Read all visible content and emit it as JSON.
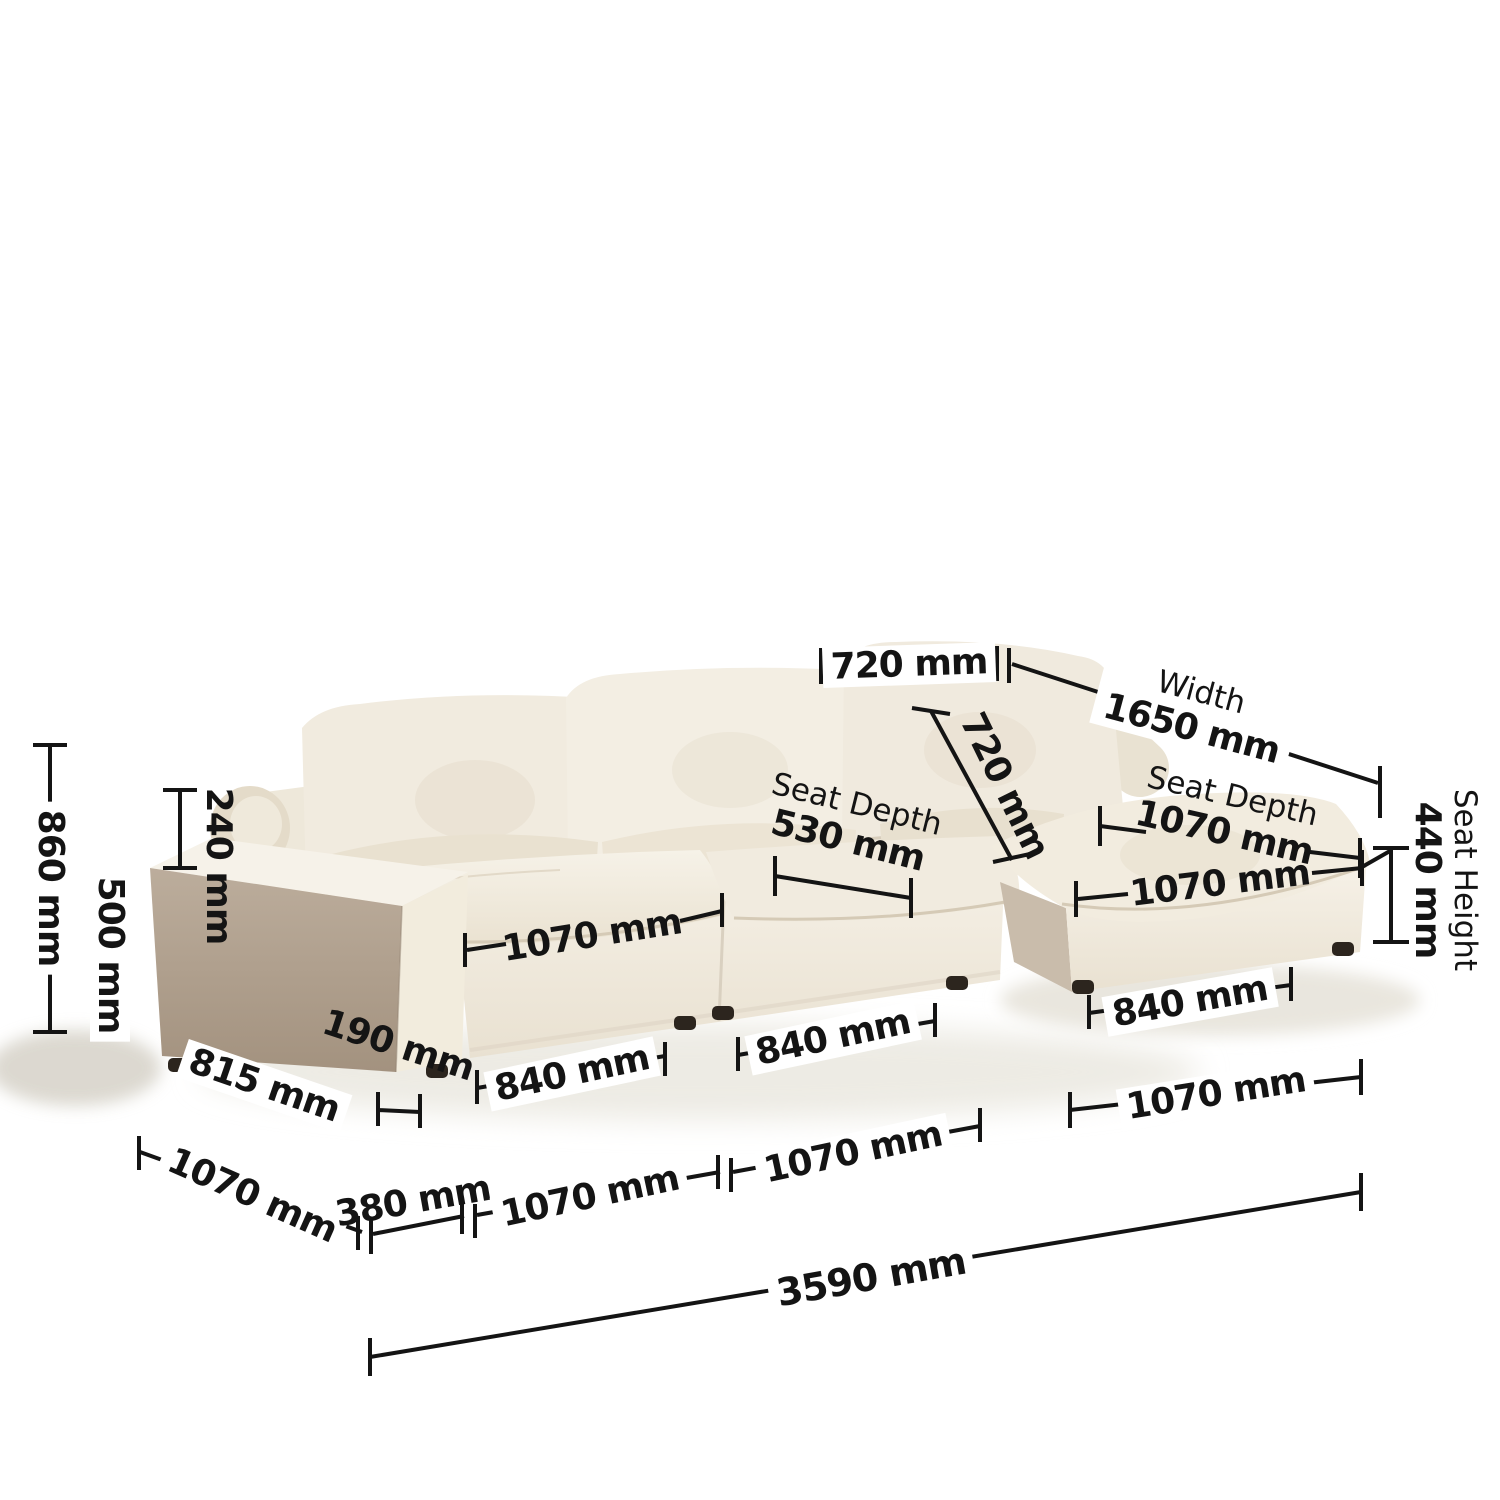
{
  "meta": {
    "description": "Product dimension diagram of a cream modular sectional cloud sofa with chaise",
    "unit": "mm"
  },
  "palette": {
    "annotation_color": "#141414",
    "background": "#ffffff",
    "sofa_cream": "#f2ecdf",
    "sofa_shadow_taupe": "#b0a08f"
  },
  "dims": {
    "back_width_top": "720 mm",
    "width_label": "Width",
    "width_value": "1650 mm",
    "back_pillow_diagonal": "720 mm",
    "seat_depth_label": "Seat Depth",
    "seat_depth_value": "530 mm",
    "chaise_seat_depth_label": "Seat Depth",
    "chaise_seat_depth_value": "1070 mm",
    "chaise_front_width": "1070 mm",
    "seat_height_label": "Seat Height",
    "seat_height_value": "440 mm",
    "overall_height": "860 mm",
    "backrest_above_arm": "240 mm",
    "arm_height": "500 mm",
    "arm_depth": "815 mm",
    "arm_thickness": "190 mm",
    "seat1_cushion_width": "1070 mm",
    "module1_width": "840 mm",
    "module2_width": "840 mm",
    "chaise_module_width": "840 mm",
    "depth_left": "1070 mm",
    "front_offset": "380 mm",
    "front_segment_a": "1070 mm",
    "front_segment_b": "1070 mm",
    "chaise_length": "1070 mm",
    "overall_length": "3590 mm"
  }
}
